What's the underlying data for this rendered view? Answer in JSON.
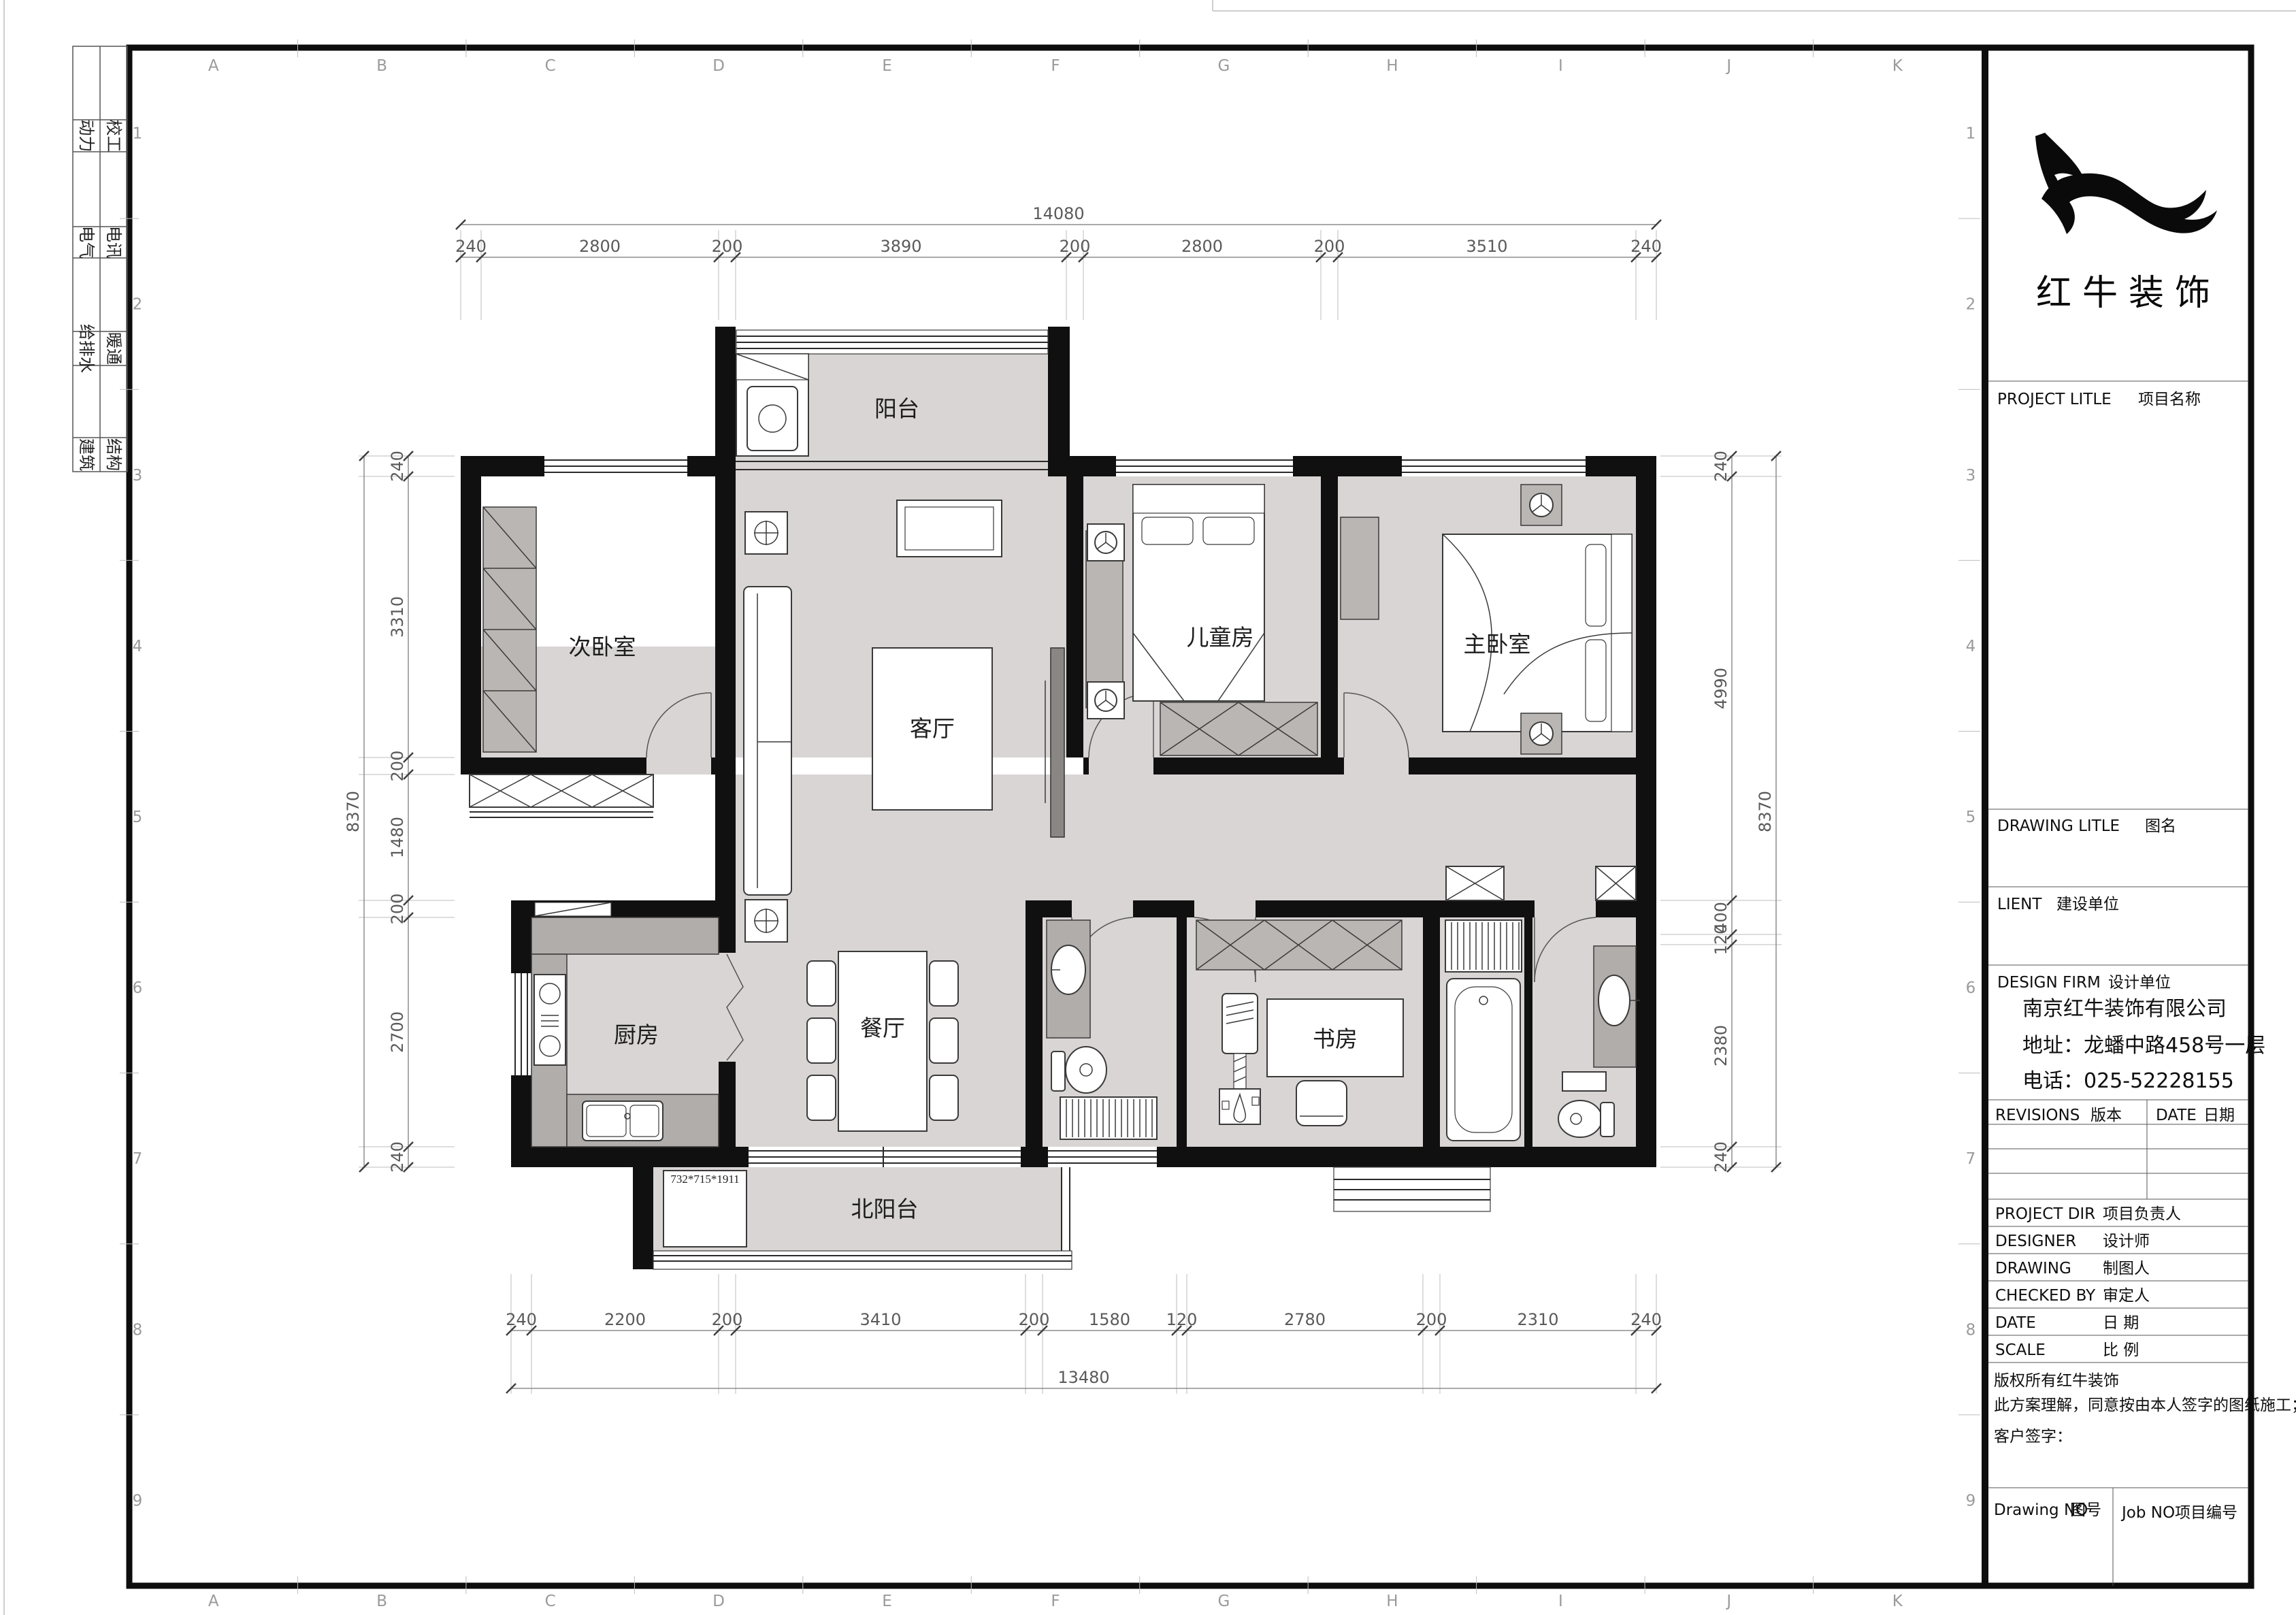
{
  "grid": {
    "col_letters": [
      "A",
      "B",
      "C",
      "D",
      "E",
      "F",
      "G",
      "H",
      "I",
      "J",
      "K"
    ],
    "row_numbers": [
      "1",
      "2",
      "3",
      "4",
      "5",
      "6",
      "7",
      "8",
      "9"
    ]
  },
  "margin_disciplines": [
    {
      "col1": "动力",
      "col2": "校工"
    },
    {
      "col1": "电气",
      "col2": "电讯"
    },
    {
      "col1": "给排水",
      "col2": "暖通"
    },
    {
      "col1": "建筑",
      "col2": "结构"
    }
  ],
  "plan": {
    "rooms": {
      "balcony": "阳台",
      "second_bedroom": "次卧室",
      "living": "客厅",
      "kids_room": "儿童房",
      "master_bedroom": "主卧室",
      "kitchen": "厨房",
      "dining": "餐厅",
      "study": "书房",
      "north_balcony": "北阳台"
    },
    "annotations": {
      "cabinet_size": "732*715*1911"
    }
  },
  "dims": {
    "top": {
      "overall": "14080",
      "segments": [
        "240",
        "2800",
        "200",
        "3890",
        "200",
        "2800",
        "200",
        "3510",
        "240"
      ]
    },
    "bottom": {
      "overall": "13480",
      "segments": [
        "240",
        "2200",
        "200",
        "3410",
        "200",
        "1580",
        "120",
        "2780",
        "200",
        "2310",
        "240"
      ]
    },
    "left": {
      "overall": "8370",
      "segments": [
        "240",
        "3310",
        "200",
        "1480",
        "200",
        "2700",
        "240"
      ]
    },
    "right": {
      "overall": "8370",
      "segments": [
        "240",
        "4990",
        "400",
        "120",
        "2380",
        "240"
      ]
    }
  },
  "title_block": {
    "brand": "红牛装饰",
    "project_title": {
      "en": "PROJECT LITLE",
      "cn": "项目名称"
    },
    "drawing_title": {
      "en": "DRAWING LITLE",
      "cn": "图名"
    },
    "client": {
      "en": "LIENT",
      "cn": "建设单位"
    },
    "design_firm": {
      "en": "DESIGN FIRM",
      "cn": "设计单位"
    },
    "company": {
      "name": "南京红牛装饰有限公司",
      "address": "地址：龙蟠中路458号一层",
      "phone": "电话：025-52228155"
    },
    "revisions": {
      "en": "REVISIONS",
      "cn": "版本"
    },
    "date_col": {
      "en": "DATE",
      "cn": "日期"
    },
    "rows": [
      {
        "en": "PROJECT DIR",
        "cn": "项目负责人"
      },
      {
        "en": "DESIGNER",
        "cn": "设计师"
      },
      {
        "en": "DRAWING",
        "cn": "制图人"
      },
      {
        "en": "CHECKED BY",
        "cn": "审定人"
      },
      {
        "en": "DATE",
        "cn": "日  期"
      },
      {
        "en": "SCALE",
        "cn": "比  例"
      }
    ],
    "copyright_line1": "版权所有红牛装饰",
    "copyright_line2": "此方案理解，同意按由本人签字的图纸施工；",
    "customer_sign": "客户签字：",
    "drawing_no": {
      "en": "Drawing NO",
      "cn": "图号"
    },
    "job_no": {
      "en": "Job NO",
      "cn": "项目编号"
    }
  }
}
